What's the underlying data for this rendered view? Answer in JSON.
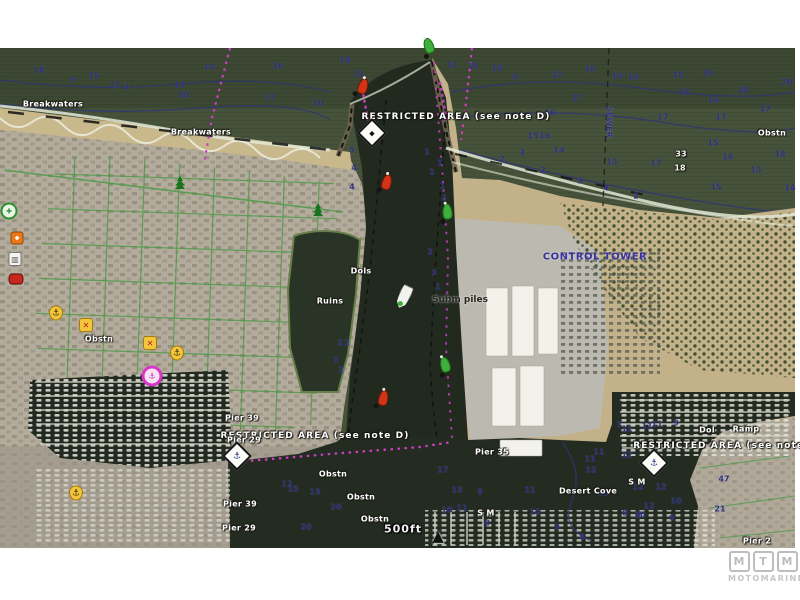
{
  "map": {
    "type": "marine-chartplotter-satellite-overlay",
    "scale_label": "500ft",
    "colors": {
      "ocean": "#46523a",
      "channel_water": "#232b21",
      "beach": "#c6b58a",
      "depth_text": "#2c2f7d",
      "magenta_route": "#cf3ec4",
      "street_green": "#3f9a3f",
      "buoy_red": "#d23418",
      "buoy_green": "#3fae3a",
      "restricted_text": "#ffffff",
      "control_tower_text": "#3a31a0"
    },
    "labels": [
      {
        "id": "breakwaters-west",
        "t": "Breakwaters",
        "s": "lws",
        "x": 53,
        "y": 104
      },
      {
        "id": "breakwaters-east",
        "t": "Breakwaters",
        "s": "lws",
        "x": 201,
        "y": 132
      },
      {
        "id": "restricted-area-north",
        "t": "RESTRICTED AREA (see note D)",
        "s": "lrw",
        "x": 456,
        "y": 117
      },
      {
        "id": "restricted-area-southwest",
        "t": "RESTRICTED AREA (see note D)",
        "s": "lrw",
        "x": 315,
        "y": 436
      },
      {
        "id": "restricted-area-east",
        "t": "RESTRICTED AREA (see note E)",
        "s": "lrw",
        "x": 727,
        "y": 446
      },
      {
        "id": "sewer",
        "t": "SEWER",
        "s": "ln",
        "x": 609,
        "y": 122,
        "r": 90
      },
      {
        "id": "obstn-1",
        "t": "Obstn",
        "s": "lws",
        "x": 99,
        "y": 339
      },
      {
        "id": "obstn-2",
        "t": "Obstn",
        "s": "lws",
        "x": 772,
        "y": 133
      },
      {
        "id": "obstn-3",
        "t": "Obstn",
        "s": "lws",
        "x": 333,
        "y": 474
      },
      {
        "id": "obstn-4",
        "t": "Obstn",
        "s": "lws",
        "x": 361,
        "y": 497
      },
      {
        "id": "obstn-5",
        "t": "Obstn",
        "s": "lws",
        "x": 375,
        "y": 519
      },
      {
        "id": "dols",
        "t": "Dols",
        "s": "lws",
        "x": 361,
        "y": 271
      },
      {
        "id": "ruins",
        "t": "Ruins",
        "s": "lws",
        "x": 330,
        "y": 301
      },
      {
        "id": "subm-piles",
        "t": "Subm piles",
        "s": "ld",
        "x": 460,
        "y": 300
      },
      {
        "id": "control-tower",
        "t": "CONTROL TOWER",
        "s": "lnb",
        "x": 595,
        "y": 257
      },
      {
        "id": "desert-cove",
        "t": "Desert Cove",
        "s": "lws",
        "x": 588,
        "y": 491
      },
      {
        "id": "dol",
        "t": "Dol",
        "s": "lws",
        "x": 707,
        "y": 430
      },
      {
        "id": "ramp",
        "t": "Ramp",
        "s": "lws",
        "x": 746,
        "y": 429
      },
      {
        "id": "sand-mud-1",
        "t": "S M",
        "s": "lws",
        "x": 486,
        "y": 513
      },
      {
        "id": "sand-mud-2",
        "t": "S M",
        "s": "lws",
        "x": 637,
        "y": 482
      },
      {
        "id": "pier-35",
        "t": "Pier 35",
        "s": "lws",
        "x": 492,
        "y": 452
      },
      {
        "id": "pier-39a",
        "t": "Pier 39",
        "s": "lws",
        "x": 242,
        "y": 418
      },
      {
        "id": "pier-29a",
        "t": "Pier 29",
        "s": "lws",
        "x": 244,
        "y": 440
      },
      {
        "id": "pier-39b",
        "t": "Pier 39",
        "s": "lws",
        "x": 240,
        "y": 504
      },
      {
        "id": "pier-29b",
        "t": "Pier 29",
        "s": "lws",
        "x": 239,
        "y": 528
      },
      {
        "id": "pier-2",
        "t": "Pier 2",
        "s": "lws",
        "x": 757,
        "y": 541
      },
      {
        "id": "spot-47",
        "t": "47",
        "s": "ln",
        "x": 724,
        "y": 479
      },
      {
        "id": "spot-21",
        "t": "21",
        "s": "ln",
        "x": 720,
        "y": 509
      },
      {
        "id": "scale",
        "t": "500ft",
        "s": "l500",
        "x": 403,
        "y": 529
      }
    ],
    "depth_soundings": [
      {
        "x": 39,
        "y": 70,
        "v": "18"
      },
      {
        "x": 73,
        "y": 80,
        "v": "9"
      },
      {
        "x": 94,
        "y": 76,
        "v": "15"
      },
      {
        "x": 115,
        "y": 85,
        "v": "11"
      },
      {
        "x": 127,
        "y": 87,
        "v": "1"
      },
      {
        "x": 180,
        "y": 85,
        "v": "11"
      },
      {
        "x": 183,
        "y": 95,
        "v": "10"
      },
      {
        "x": 209,
        "y": 67,
        "v": "14"
      },
      {
        "x": 278,
        "y": 66,
        "v": "16"
      },
      {
        "x": 270,
        "y": 97,
        "v": "11"
      },
      {
        "x": 318,
        "y": 103,
        "v": "10"
      },
      {
        "x": 345,
        "y": 60,
        "v": "18"
      },
      {
        "x": 359,
        "y": 74,
        "v": "11"
      },
      {
        "x": 452,
        "y": 65,
        "v": "11"
      },
      {
        "x": 473,
        "y": 66,
        "v": "16"
      },
      {
        "x": 497,
        "y": 68,
        "v": "16"
      },
      {
        "x": 515,
        "y": 77,
        "v": "9"
      },
      {
        "x": 557,
        "y": 75,
        "v": "17"
      },
      {
        "x": 590,
        "y": 69,
        "v": "10"
      },
      {
        "x": 617,
        "y": 76,
        "v": "16"
      },
      {
        "x": 633,
        "y": 77,
        "v": "10"
      },
      {
        "x": 678,
        "y": 75,
        "v": "18"
      },
      {
        "x": 708,
        "y": 73,
        "v": "19"
      },
      {
        "x": 743,
        "y": 90,
        "v": "18"
      },
      {
        "x": 787,
        "y": 82,
        "v": "20"
      },
      {
        "x": 713,
        "y": 100,
        "v": "16"
      },
      {
        "x": 765,
        "y": 109,
        "v": "17"
      },
      {
        "x": 721,
        "y": 117,
        "v": "17"
      },
      {
        "x": 663,
        "y": 117,
        "v": "17"
      },
      {
        "x": 684,
        "y": 92,
        "v": "18"
      },
      {
        "x": 577,
        "y": 98,
        "v": "17"
      },
      {
        "x": 550,
        "y": 113,
        "v": "16"
      },
      {
        "x": 533,
        "y": 136,
        "v": "15"
      },
      {
        "x": 545,
        "y": 136,
        "v": "16"
      },
      {
        "x": 612,
        "y": 162,
        "v": "15"
      },
      {
        "x": 656,
        "y": 163,
        "v": "17"
      },
      {
        "x": 713,
        "y": 143,
        "v": "15"
      },
      {
        "x": 728,
        "y": 157,
        "v": "16"
      },
      {
        "x": 780,
        "y": 154,
        "v": "18"
      },
      {
        "x": 756,
        "y": 170,
        "v": "15"
      },
      {
        "x": 716,
        "y": 187,
        "v": "15"
      },
      {
        "x": 790,
        "y": 188,
        "v": "14"
      },
      {
        "x": 681,
        "y": 154,
        "v": "33",
        "w": true
      },
      {
        "x": 680,
        "y": 168,
        "v": "18",
        "w": true
      },
      {
        "x": 559,
        "y": 150,
        "v": "14"
      },
      {
        "x": 522,
        "y": 153,
        "v": "3"
      },
      {
        "x": 502,
        "y": 159,
        "v": "2"
      },
      {
        "x": 543,
        "y": 170,
        "v": "2"
      },
      {
        "x": 580,
        "y": 181,
        "v": "3"
      },
      {
        "x": 606,
        "y": 188,
        "v": "4"
      },
      {
        "x": 636,
        "y": 196,
        "v": "2"
      },
      {
        "x": 427,
        "y": 152,
        "v": "1"
      },
      {
        "x": 440,
        "y": 163,
        "v": "1"
      },
      {
        "x": 352,
        "y": 150,
        "v": "5"
      },
      {
        "x": 354,
        "y": 168,
        "v": "4"
      },
      {
        "x": 352,
        "y": 187,
        "v": "4"
      },
      {
        "x": 432,
        "y": 172,
        "v": "1"
      },
      {
        "x": 442,
        "y": 186,
        "v": "1"
      },
      {
        "x": 444,
        "y": 198,
        "v": "2"
      },
      {
        "x": 430,
        "y": 252,
        "v": "2"
      },
      {
        "x": 434,
        "y": 273,
        "v": "3"
      },
      {
        "x": 438,
        "y": 287,
        "v": "1"
      },
      {
        "x": 340,
        "y": 343,
        "v": "2"
      },
      {
        "x": 347,
        "y": 343,
        "v": "2"
      },
      {
        "x": 336,
        "y": 360,
        "v": "1"
      },
      {
        "x": 341,
        "y": 370,
        "v": "2"
      },
      {
        "x": 443,
        "y": 470,
        "v": "17"
      },
      {
        "x": 457,
        "y": 490,
        "v": "13"
      },
      {
        "x": 447,
        "y": 510,
        "v": "10"
      },
      {
        "x": 462,
        "y": 508,
        "v": "11"
      },
      {
        "x": 480,
        "y": 492,
        "v": "9"
      },
      {
        "x": 487,
        "y": 523,
        "v": "8"
      },
      {
        "x": 530,
        "y": 490,
        "v": "11"
      },
      {
        "x": 535,
        "y": 512,
        "v": "10"
      },
      {
        "x": 557,
        "y": 527,
        "v": "9"
      },
      {
        "x": 603,
        "y": 493,
        "v": "11"
      },
      {
        "x": 638,
        "y": 487,
        "v": "12"
      },
      {
        "x": 640,
        "y": 515,
        "v": "10"
      },
      {
        "x": 582,
        "y": 537,
        "v": "8"
      },
      {
        "x": 306,
        "y": 527,
        "v": "20"
      },
      {
        "x": 336,
        "y": 507,
        "v": "20"
      },
      {
        "x": 315,
        "y": 492,
        "v": "13"
      },
      {
        "x": 293,
        "y": 489,
        "v": "15"
      },
      {
        "x": 287,
        "y": 484,
        "v": "12"
      },
      {
        "x": 619,
        "y": 425,
        "v": "7"
      },
      {
        "x": 627,
        "y": 429,
        "v": "11"
      },
      {
        "x": 647,
        "y": 426,
        "v": "11"
      },
      {
        "x": 657,
        "y": 424,
        "v": "11"
      },
      {
        "x": 676,
        "y": 423,
        "v": "9"
      },
      {
        "x": 599,
        "y": 452,
        "v": "11"
      },
      {
        "x": 627,
        "y": 455,
        "v": "12"
      },
      {
        "x": 590,
        "y": 459,
        "v": "11"
      },
      {
        "x": 591,
        "y": 470,
        "v": "12"
      },
      {
        "x": 661,
        "y": 487,
        "v": "12"
      },
      {
        "x": 676,
        "y": 501,
        "v": "10"
      },
      {
        "x": 649,
        "y": 506,
        "v": "12"
      },
      {
        "x": 672,
        "y": 518,
        "v": "9"
      },
      {
        "x": 639,
        "y": 515,
        "v": "7"
      },
      {
        "x": 625,
        "y": 513,
        "v": "8"
      }
    ],
    "buoys": [
      {
        "c": "red",
        "x": 360,
        "y": 92,
        "r": 18
      },
      {
        "c": "red",
        "x": 384,
        "y": 188,
        "r": 15
      },
      {
        "c": "red",
        "x": 381,
        "y": 404,
        "r": 12
      },
      {
        "c": "green",
        "x": 430,
        "y": 52,
        "r": -18
      },
      {
        "c": "green",
        "x": 447,
        "y": 218,
        "r": -5
      },
      {
        "c": "green",
        "x": 446,
        "y": 371,
        "r": -15
      }
    ],
    "hazard_diamonds": [
      {
        "x": 372,
        "y": 133,
        "g": "info"
      },
      {
        "x": 237,
        "y": 456,
        "g": "anchor"
      },
      {
        "x": 654,
        "y": 463,
        "g": "anchor"
      }
    ],
    "poi_icons": [
      {
        "t": "services-green",
        "x": 9,
        "y": 211
      },
      {
        "t": "food",
        "x": 17,
        "y": 238
      },
      {
        "t": "shop",
        "x": 15,
        "y": 259
      },
      {
        "t": "car",
        "x": 16,
        "y": 279
      },
      {
        "t": "danger",
        "x": 86,
        "y": 325
      },
      {
        "t": "danger",
        "x": 150,
        "y": 343
      },
      {
        "t": "anchorage",
        "x": 56,
        "y": 313
      },
      {
        "t": "anchorage",
        "x": 177,
        "y": 353
      },
      {
        "t": "anchorage",
        "x": 76,
        "y": 493
      },
      {
        "t": "marina",
        "x": 152,
        "y": 376
      }
    ],
    "tree_icons": [
      {
        "x": 180,
        "y": 189
      },
      {
        "x": 318,
        "y": 216
      }
    ],
    "vessel": {
      "x": 404,
      "y": 297,
      "r": 205
    },
    "north_arrow": {
      "x": 438,
      "y": 536,
      "glyph": "▲"
    }
  },
  "watermark": {
    "letters": [
      "M",
      "T",
      "M"
    ],
    "name": "MOTOMARINE"
  }
}
